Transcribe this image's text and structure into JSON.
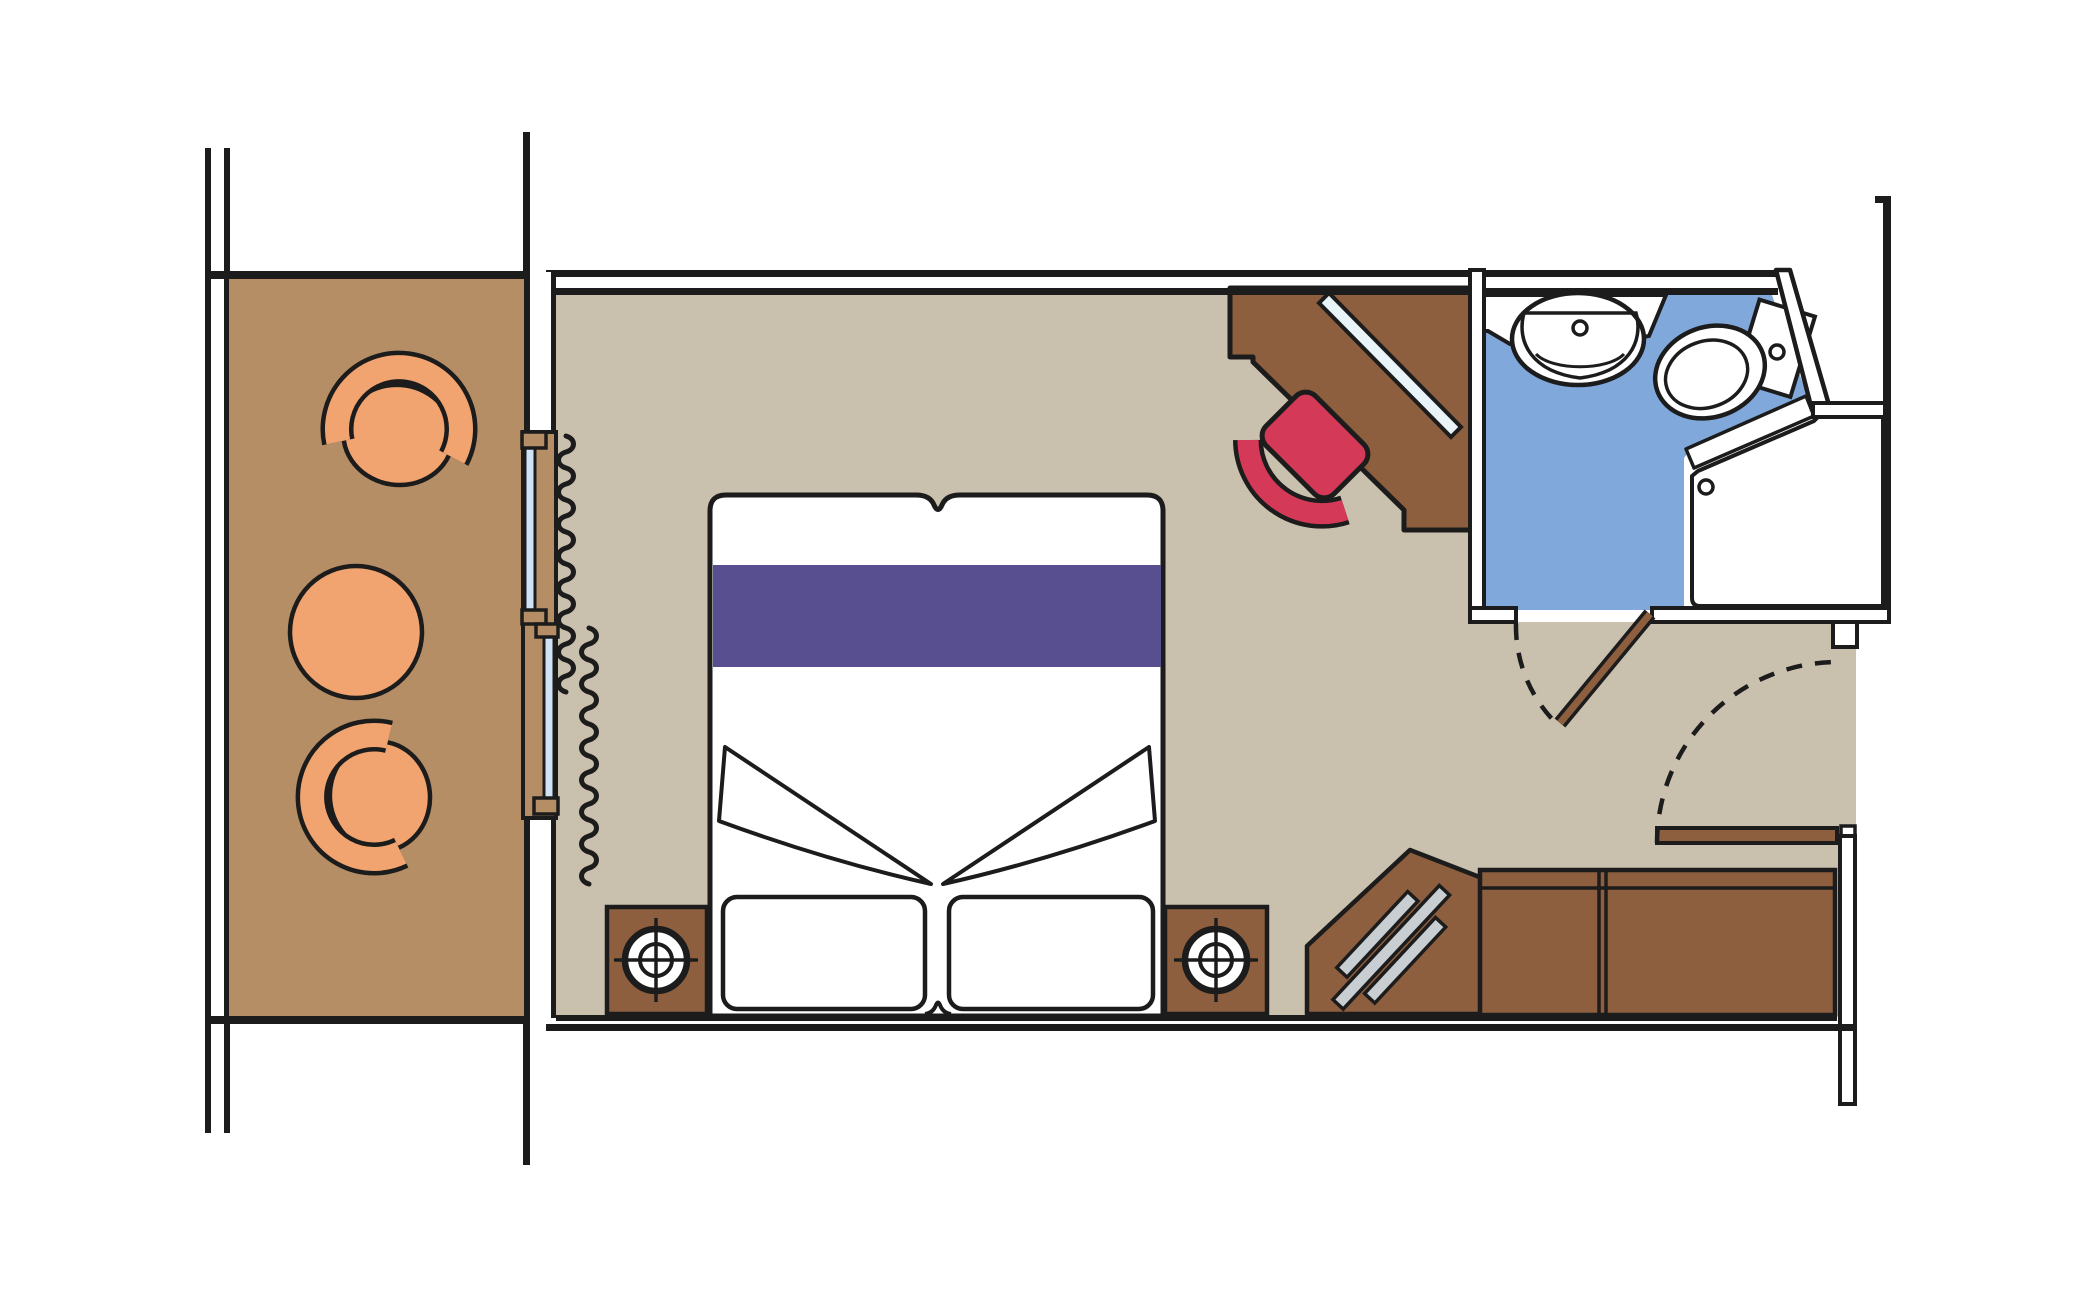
{
  "plan": {
    "kind": "cruise-ship-cabin-floorplan",
    "rooms": {
      "balcony": {
        "furniture": [
          "tub-armchair",
          "round-table",
          "tub-armchair"
        ]
      },
      "cabin": {
        "furniture": [
          "double-bed",
          "bed-runner",
          "pillow",
          "pillow",
          "nightstand-lamp",
          "nightstand-lamp",
          "corner-desk",
          "mirror",
          "desk-chair",
          "wardrobe",
          "luggage-rack",
          "entrance-door"
        ]
      },
      "bathroom": {
        "fixtures": [
          "sink",
          "toilet",
          "shower",
          "bathroom-door"
        ]
      }
    }
  },
  "colors": {
    "line": "#1c1c1c",
    "balcony_floor": "#b58e66",
    "cabin_floor": "#cac0ae",
    "bathroom_floor": "#80a8db",
    "wood_furniture": "#8d5f3f",
    "upholstery_orange": "#f1a46f",
    "chair_red": "#d43a57",
    "bed_runner_purple": "#584f90",
    "window_glass": "#cfe3f5",
    "mirror_glass": "#e9f4f9",
    "rack_metal": "#c9ced3",
    "fixture_white": "#ffffff",
    "wall_white": "#ffffff"
  }
}
